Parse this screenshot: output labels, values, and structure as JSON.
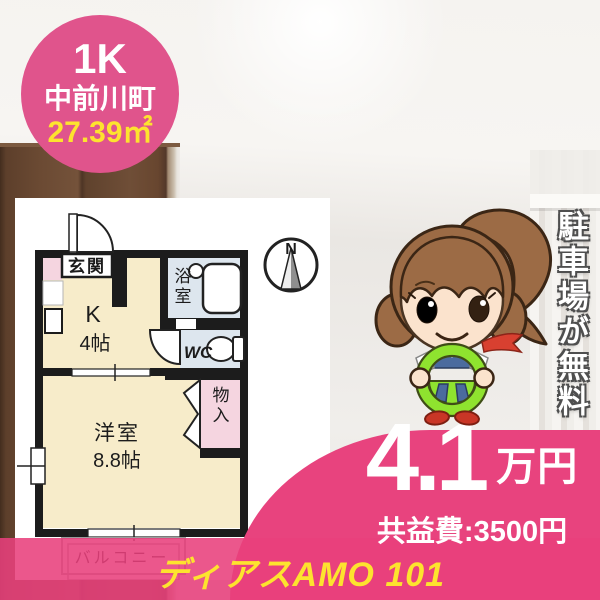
{
  "badge": {
    "layout": "1K",
    "town": "中前川町",
    "area": "27.39㎡"
  },
  "floorplan": {
    "compass": "N",
    "entrance": "玄関",
    "kitchen": "K",
    "kitchen_size": "4帖",
    "bath": "浴室",
    "toilet": "WC",
    "closet": "物入",
    "main_room": "洋室",
    "main_room_size": "8.8帖",
    "balcony": "バルコニー"
  },
  "ribbon": {
    "text": "駐車場が無料"
  },
  "price": {
    "rent": "4.1",
    "unit": "万円",
    "common_fee": "共益費:3500円"
  },
  "property": {
    "name": "ディアスAMO 101"
  },
  "colors": {
    "badge_pink": "#e0548c",
    "accent_pink": "#e8437e",
    "accent_yellow": "#fde32e",
    "plan_cream": "#f7ecca",
    "plan_blue": "#dde6ee",
    "plan_pink": "#f5d5e0"
  }
}
